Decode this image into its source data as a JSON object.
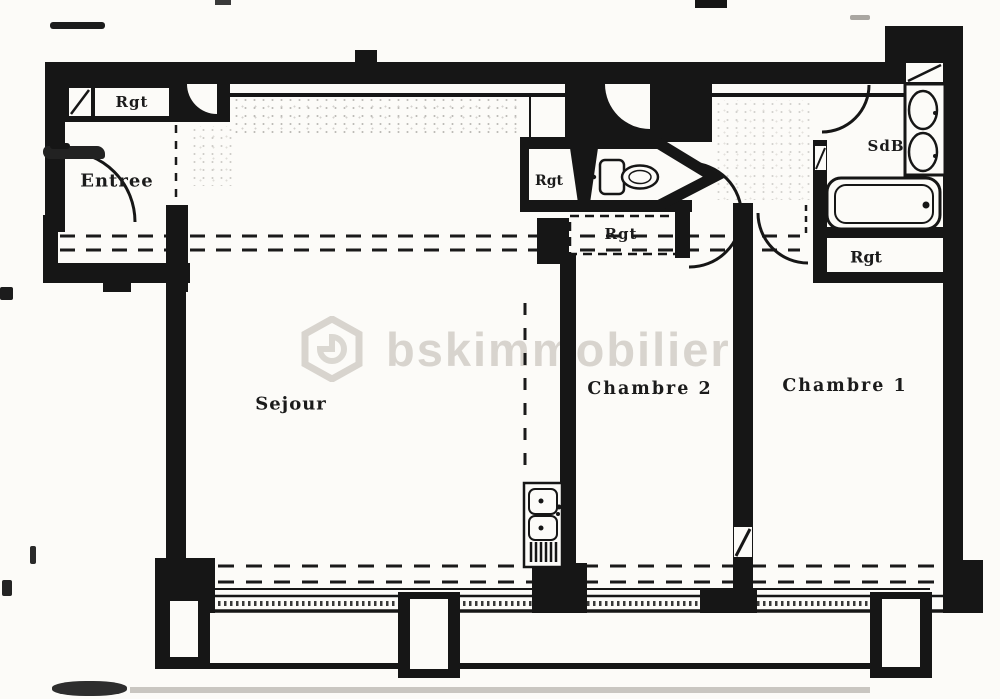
{
  "plan": {
    "rooms": {
      "entree": "Entree",
      "sejour": "Sejour",
      "chambre2": "Chambre 2",
      "chambre1": "Chambre 1",
      "sdb": "SdB"
    },
    "closets": {
      "rgt_entry": "Rgt",
      "rgt_wc": "Rgt",
      "rgt_hall": "Rgt",
      "rgt_sdb": "Rgt"
    },
    "watermark": {
      "text": "bskimmobilier",
      "logo": "hexagon-logo-icon"
    },
    "colors": {
      "wall": "#161616",
      "paper": "#fcfbf8",
      "watermark_gray": "#bab5ac"
    },
    "icons": {
      "toilet": "toilet-icon",
      "bathtub": "bathtub-icon",
      "washbasin_1": "washbasin-icon",
      "washbasin_2": "washbasin-icon",
      "kitchen_sink": "kitchen-sink-icon",
      "door_swing": "door-swing-arc-icon"
    }
  }
}
